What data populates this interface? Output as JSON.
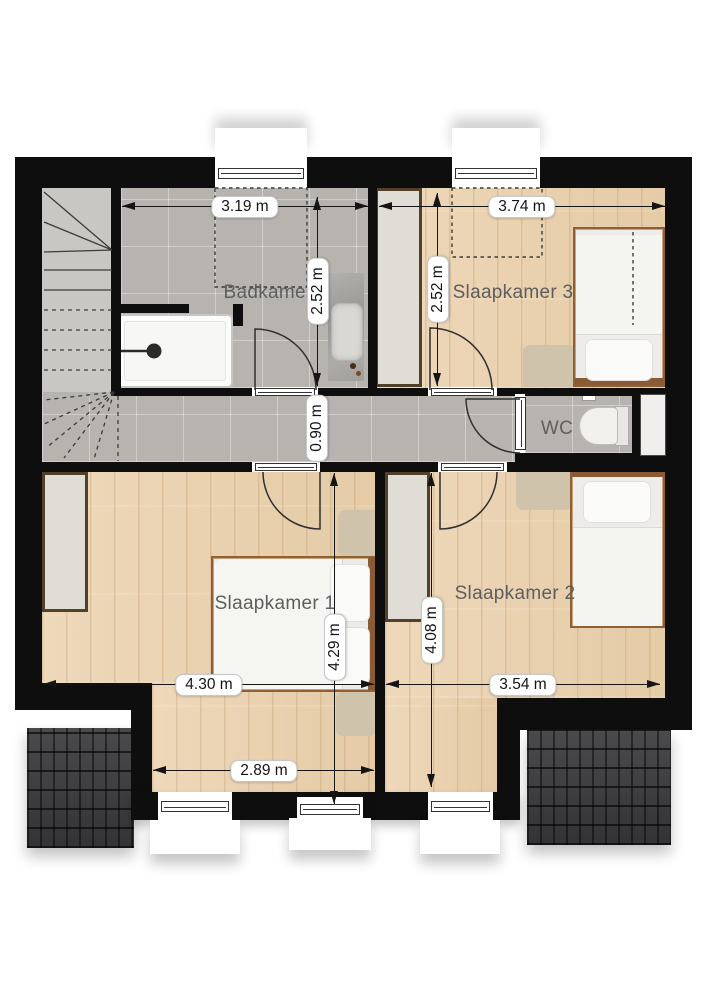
{
  "rooms": [
    {
      "id": "badkamer",
      "label": "Badkamer"
    },
    {
      "id": "slaapkamer-3",
      "label": "Slaapkamer 3"
    },
    {
      "id": "wc",
      "label": "WC"
    },
    {
      "id": "slaapkamer-1",
      "label": "Slaapkamer 1"
    },
    {
      "id": "slaapkamer-2",
      "label": "Slaapkamer 2"
    }
  ],
  "dimensions": [
    {
      "id": "badkamer-width",
      "text": "3.19 m",
      "orientation": "horizontal"
    },
    {
      "id": "slaapkamer-3-width",
      "text": "3.74 m",
      "orientation": "horizontal"
    },
    {
      "id": "badkamer-depth",
      "text": "2.52 m",
      "orientation": "vertical"
    },
    {
      "id": "slaapkamer-3-depth",
      "text": "2.52 m",
      "orientation": "vertical"
    },
    {
      "id": "hallway-width",
      "text": "0.90 m",
      "orientation": "vertical"
    },
    {
      "id": "slaapkamer-1-depth",
      "text": "4.29 m",
      "orientation": "vertical"
    },
    {
      "id": "slaapkamer-2-depth",
      "text": "4.08 m",
      "orientation": "vertical"
    },
    {
      "id": "slaapkamer-1-width",
      "text": "4.30 m",
      "orientation": "horizontal"
    },
    {
      "id": "slaapkamer-2-width",
      "text": "3.54 m",
      "orientation": "horizontal"
    },
    {
      "id": "slaapkamer-1-bay-width",
      "text": "2.89 m",
      "orientation": "horizontal"
    }
  ],
  "colors": {
    "wall": "#0e0e0e",
    "wood_floor": "#ead3b2",
    "tile_floor": "#b7b4af",
    "stairs_floor": "#c9c7c3",
    "roof_tiles": "#3b3b3e",
    "bed_frame_wood": "#8f5f35",
    "rug": "#cfc3ab",
    "dimension_text": "#141414",
    "room_label_text": "#5e5e5e"
  }
}
